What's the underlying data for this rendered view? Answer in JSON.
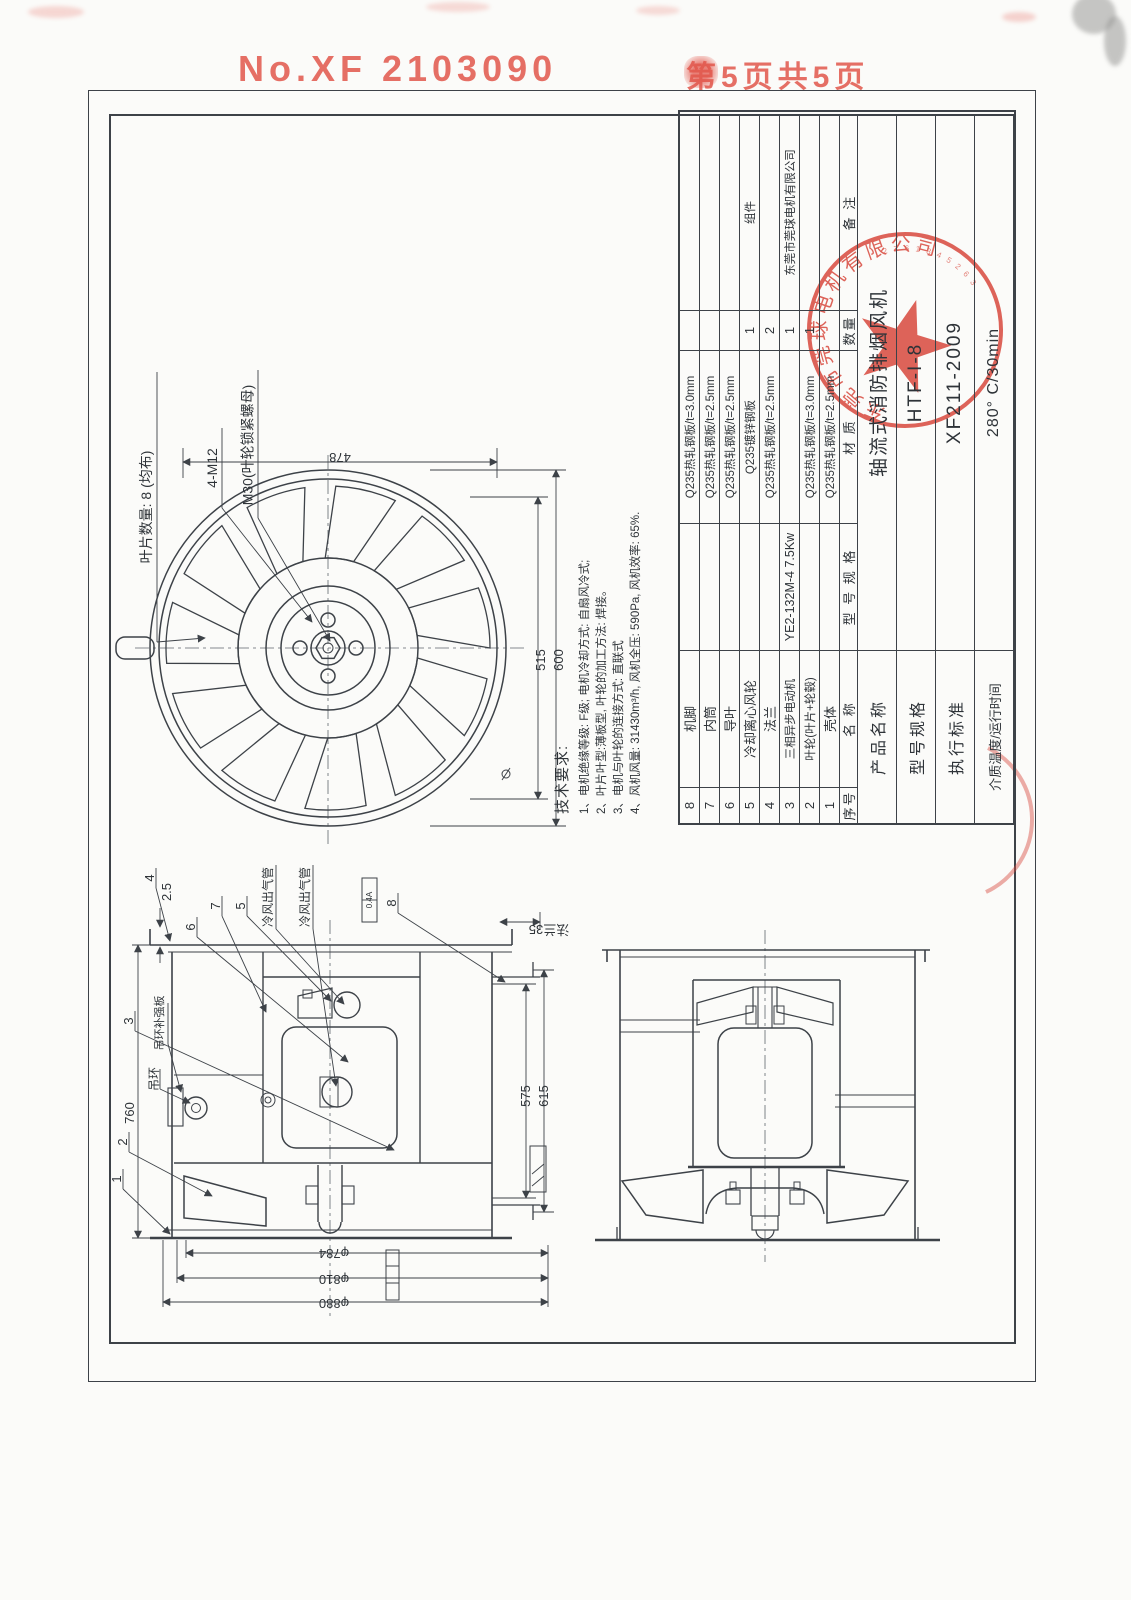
{
  "page_header": {
    "serial": "No.XF 2103090",
    "page": "第5页共5页"
  },
  "title_block": {
    "header": {
      "seq": "序号",
      "name": "名  称",
      "spec": "型 号 规 格",
      "material": "材  质",
      "qty": "数量",
      "note": "备 注"
    },
    "parts": [
      {
        "seq": "8",
        "name": "机脚",
        "spec": "",
        "material": "Q235热轧钢板/t=3.0mm",
        "qty": "",
        "note": ""
      },
      {
        "seq": "7",
        "name": "内筒",
        "spec": "",
        "material": "Q235热轧钢板/t=2.5mm",
        "qty": "",
        "note": ""
      },
      {
        "seq": "6",
        "name": "导叶",
        "spec": "",
        "material": "Q235热轧钢板/t=2.5mm",
        "qty": "",
        "note": ""
      },
      {
        "seq": "5",
        "name": "冷却离心风轮",
        "spec": "",
        "material": "Q235镀锌钢板",
        "qty": "1",
        "note": "组件"
      },
      {
        "seq": "4",
        "name": "法兰",
        "spec": "",
        "material": "Q235热轧钢板/t=2.5mm",
        "qty": "2",
        "note": ""
      },
      {
        "seq": "3",
        "name": "三相异步电动机",
        "spec": "YE2-132M-4 7.5Kw",
        "material": "",
        "qty": "1",
        "note": "东莞市莞球电机有限公司"
      },
      {
        "seq": "2",
        "name": "叶轮(叶片+轮毂)",
        "spec": "",
        "material": "Q235热轧钢板/t=3.0mm",
        "qty": "1",
        "note": ""
      },
      {
        "seq": "1",
        "name": "壳体",
        "spec": "",
        "material": "Q235热轧钢板/t=2.5mm",
        "qty": "",
        "note": ""
      }
    ],
    "info_rows": [
      {
        "label": "产品名称",
        "value": "轴流式消防排烟风机"
      },
      {
        "label": "型号规格",
        "value": "HTF-I-8"
      },
      {
        "label": "执行标准",
        "value": "XF211-2009"
      },
      {
        "label": "介质温度/运行时间",
        "value": "280° C/30min"
      }
    ]
  },
  "tech_notes": {
    "title": "技术要求:",
    "items": [
      "1、电机绝缘等级: F级; 电机冷却方式: 自扇风冷式;",
      "2、叶片叶型:薄板型, 叶轮的加工方法: 焊接。",
      "3、电机与叶轮的连接方式: 直联式",
      "4、风机风量: 31430m³/h, 风机全压: 590Pa, 风机效率: 65%."
    ]
  },
  "impeller_view": {
    "labels": {
      "blade_count": "叶片数量: 8 (均布)",
      "bolts": "4-M12",
      "nut": "M30(叶轮锁紧螺母)"
    },
    "dims": {
      "d478": "478",
      "d515": "515",
      "d600": "600"
    }
  },
  "section_view": {
    "part_refs": {
      "n1": "1",
      "n2": "2",
      "n3": "3",
      "n4": "4",
      "n5": "5",
      "n6": "6",
      "n7": "7",
      "n8": "8"
    },
    "dims": {
      "d2_5": "2.5",
      "d760": "760",
      "d575": "575",
      "d615": "615",
      "d784": "φ784",
      "d810": "φ810",
      "d880": "φ880",
      "flange": "法兰35"
    },
    "labels": {
      "cold_air_1": "冷风出气管",
      "cold_air_2": "冷风出气管",
      "lifting_ring": "吊环",
      "lifting_ring_plate": "吊环补强板",
      "weld_note": "0.4A"
    }
  },
  "stamp": {
    "company_arc": "东莞市莞球电机有限公司",
    "digits_arc": "2 7 6 1 3 4 5 2 6 3"
  },
  "colors": {
    "red": "#e2574c",
    "line": "#3d4248"
  }
}
